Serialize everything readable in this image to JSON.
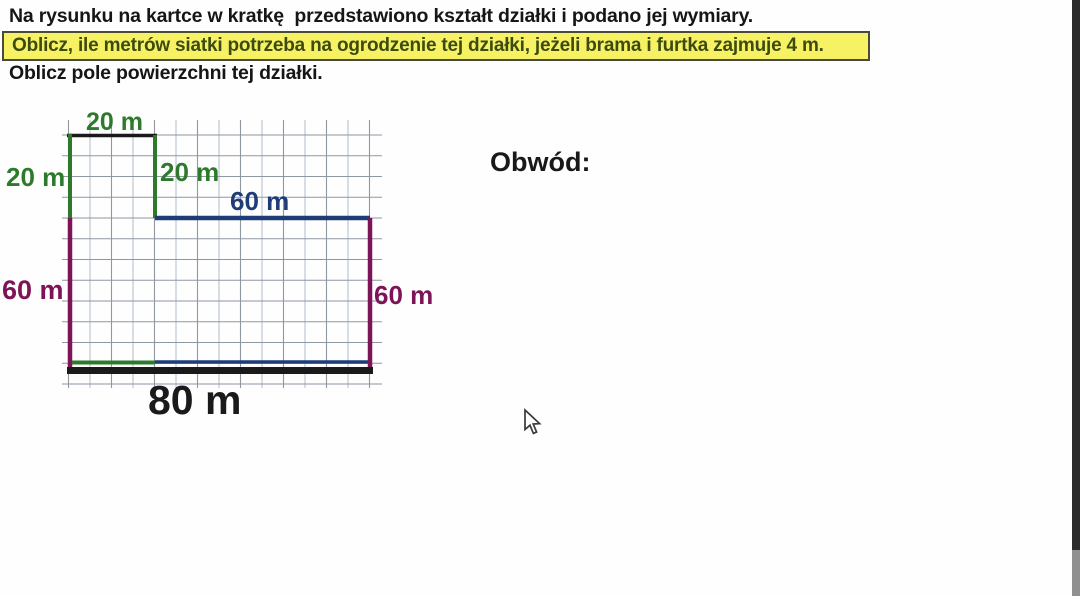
{
  "problem": {
    "intro": "Na rysunku na kartce w kratkę  przedstawiono kształt działki i podano jej wymiary.",
    "fence_task": "Oblicz, ile metrów siatki potrzeba na ogrodzenie tej działki, jeżeli brama i furtka zajmuje 4 m.",
    "area_task": "Oblicz pole powierzchni tej działki."
  },
  "diagram": {
    "labels": {
      "top_width": "20 m",
      "left_upper_height": "20 m",
      "step_height": "20 m",
      "step_width": "60 m",
      "left_lower_height": "60 m",
      "right_height": "60 m",
      "bottom_width": "80 m"
    },
    "colors": {
      "green": "#2e7a2c",
      "navy": "#1e3c78",
      "purple": "#7d1457",
      "ink": "#1a1a1a",
      "grid": "#8f97a1",
      "grid_light": "#b7c2d0"
    }
  },
  "answer": {
    "perimeter_label": "Obwód:"
  },
  "highlight": {
    "background": "#f6f263",
    "border": "#4a4a3a",
    "text_color": "#3d4b12"
  }
}
